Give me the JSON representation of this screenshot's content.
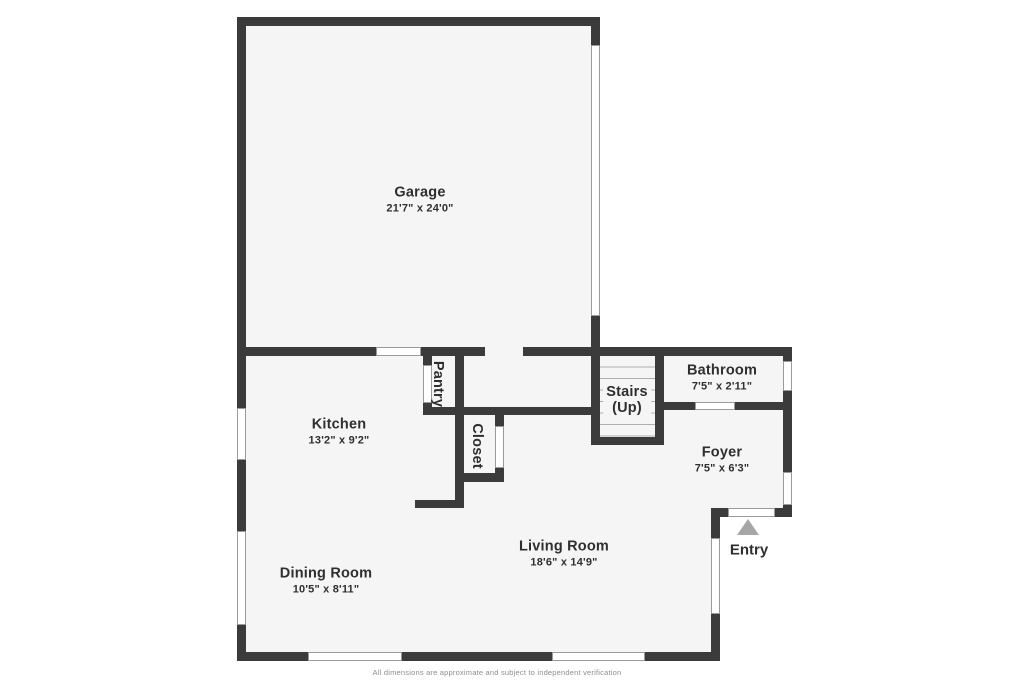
{
  "plan_title": "First floor plan",
  "rooms": {
    "garage": {
      "name": "Garage",
      "dims": "21'7\" x 24'0\""
    },
    "kitchen": {
      "name": "Kitchen",
      "dims": "13'2\" x 9'2\""
    },
    "pantry": {
      "name": "Pantry"
    },
    "closet": {
      "name": "Closet"
    },
    "stairs": {
      "name": "Stairs",
      "dims": "(Up)"
    },
    "bathroom": {
      "name": "Bathroom",
      "dims": "7'5\" x 2'11\""
    },
    "foyer": {
      "name": "Foyer",
      "dims": "7'5\" x 6'3\""
    },
    "living_room": {
      "name": "Living Room",
      "dims": "18'6\" x 14'9\""
    },
    "dining_room": {
      "name": "Dining Room",
      "dims": "10'5\" x 8'11\""
    },
    "entry": {
      "name": "Entry"
    }
  },
  "icons": {
    "entry_arrow": "triangle-up-icon"
  },
  "footer": {
    "disclaimer": "All dimensions are approximate and subject to independent verification"
  },
  "colors": {
    "wall": "#3b3b3b",
    "floor": "#f5f5f5",
    "window_outline": "#9a9a9a",
    "entry_arrow": "#a6a6a6",
    "text": "#2f2f2f"
  }
}
